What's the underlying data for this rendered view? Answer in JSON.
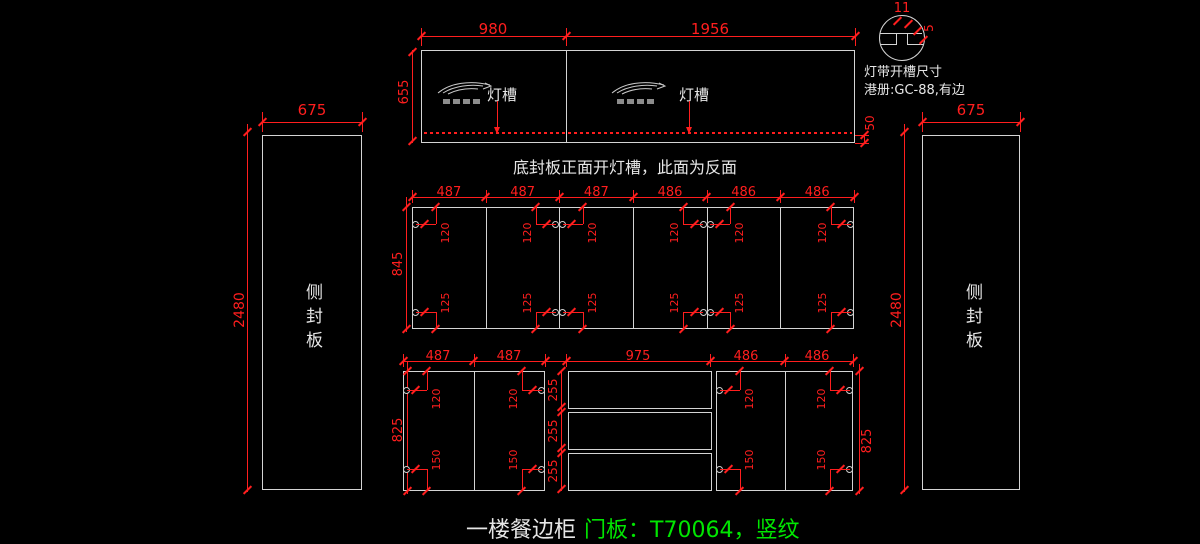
{
  "colors": {
    "background": "#000000",
    "drawing_line": "#d4d4d4",
    "dimension_red": "#ff1e1e",
    "text_white": "#e6e6e6",
    "highlight_green": "#00e600"
  },
  "icons": {
    "brand_logo": "swoosh-bird-logo",
    "detail_circle": "groove-section-detail"
  },
  "detail_callout": {
    "groove_width": "11",
    "groove_depth": "5",
    "line1": "灯带开槽尺寸",
    "line2": "港册:GC-88,有边"
  },
  "top_panel": {
    "width_left": "980",
    "width_right": "1956",
    "height": "655",
    "groove_to_edge": "50",
    "groove_labels": [
      "灯槽",
      "灯槽"
    ],
    "caption": "底封板正面开灯槽，此面为反面"
  },
  "side_panels": {
    "left": {
      "width": "675",
      "height": "2480",
      "label": "侧封板"
    },
    "right": {
      "width": "675",
      "height": "2480",
      "label": "侧封板"
    }
  },
  "upper_doors": {
    "widths": [
      "487",
      "487",
      "487",
      "486",
      "486",
      "486"
    ],
    "height": "845",
    "hole_from_top": "120",
    "hole_from_bottom": "125"
  },
  "lower_row": {
    "left_door_widths": [
      "487",
      "487"
    ],
    "drawer_width": "975",
    "right_door_widths": [
      "486",
      "486"
    ],
    "height": "825",
    "height_right": "825",
    "drawer_front_heights": [
      "255",
      "255",
      "255"
    ],
    "hole_from_top": "120",
    "hole_from_bottom": "150"
  },
  "footer": {
    "name": "一楼餐边柜",
    "door_spec": "门板：T70064，竖纹"
  }
}
